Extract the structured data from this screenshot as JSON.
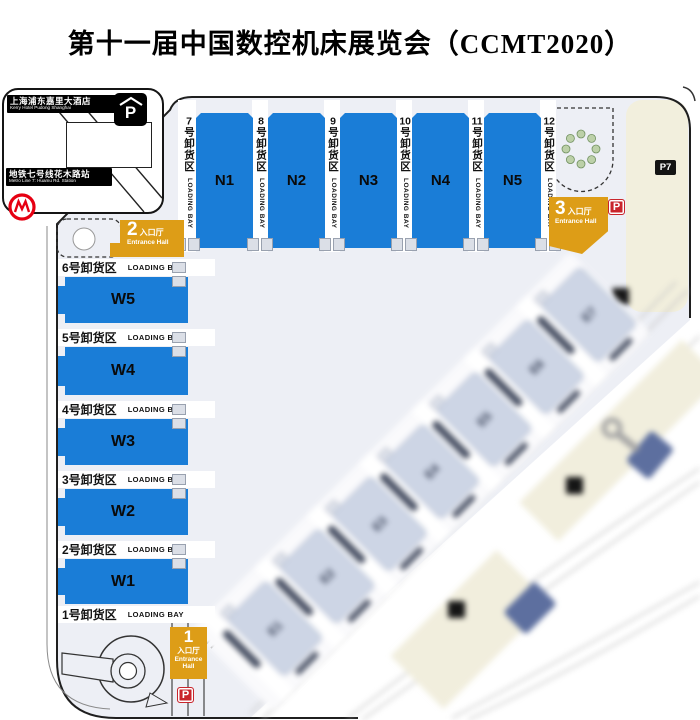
{
  "title": "第十一届中国数控机床展览会（CCMT2020）",
  "legend": {
    "hotel": {
      "zh": "上海浦东嘉里大酒店",
      "en": "Kerry Hotel Pudong Shanghai"
    },
    "metro": {
      "zh": "地铁七号线花木路站",
      "en": "Metro Line 7: Huamu Rd. Station"
    }
  },
  "labels": {
    "loading_bay": "LOADING BAY"
  },
  "north_halls": [
    "N1",
    "N2",
    "N3",
    "N4",
    "N5"
  ],
  "north_bays": [
    {
      "num": "7",
      "zh": "号卸货区"
    },
    {
      "num": "8",
      "zh": "号卸货区"
    },
    {
      "num": "9",
      "zh": "号卸货区"
    },
    {
      "num": "10",
      "zh": "号卸货区"
    },
    {
      "num": "11",
      "zh": "号卸货区"
    },
    {
      "num": "12",
      "zh": "号卸货区"
    }
  ],
  "west_halls": [
    "W5",
    "W4",
    "W3",
    "W2",
    "W1"
  ],
  "west_bays": [
    "6号卸货区",
    "5号卸货区",
    "4号卸货区",
    "3号卸货区",
    "2号卸货区",
    "1号卸货区"
  ],
  "east_halls": [
    "E1",
    "E2",
    "E3",
    "E4",
    "E5",
    "E6",
    "E7"
  ],
  "entrances": {
    "e1": {
      "num": "1",
      "zh": "入口厅",
      "en": "Entrance Hall"
    },
    "e2": {
      "num": "2",
      "zh": "入口厅",
      "en": "Entrance Hall"
    },
    "e3": {
      "num": "3",
      "zh": "入口厅",
      "en": "Entrance Hall"
    }
  },
  "parking": {
    "p": "P",
    "p7": "P7"
  },
  "colors": {
    "hall_blue": "#1a7dd7",
    "entrance_orange": "#dd9d17",
    "parking_red": "#c9252c",
    "concourse": "#edeff5",
    "east_hall_fill": "#cdd5e5",
    "cream_parking": "#f2efdd"
  }
}
